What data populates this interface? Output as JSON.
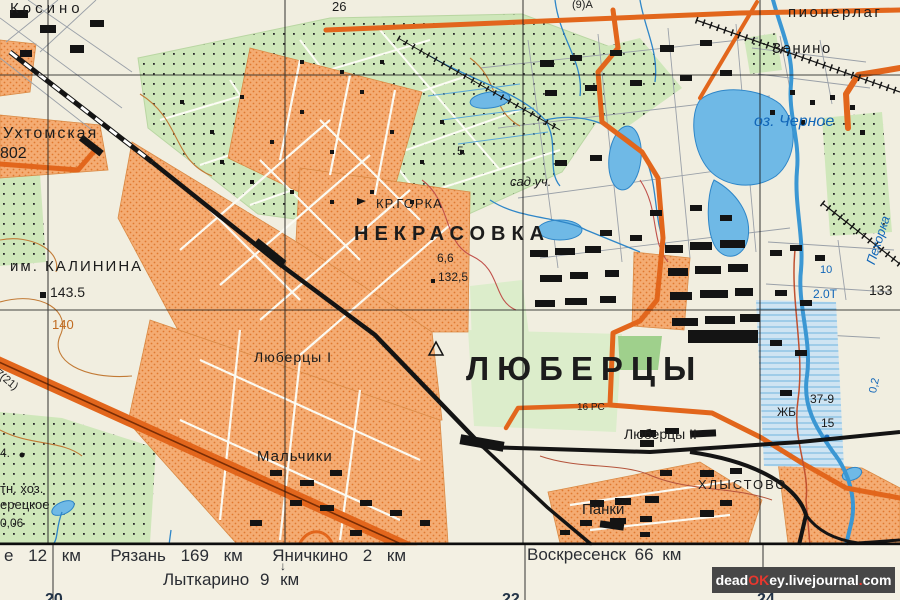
{
  "map": {
    "colors": {
      "background": "#f1eee0",
      "urban_fill": "#f4ac73",
      "urban_dot": "#e0792f",
      "road_orange": "#e2661c",
      "rail_black": "#141414",
      "water_fill": "#6fb9e6",
      "water_line": "#2e86c8",
      "veg_green": "#cfe7ba",
      "park_green": "#9fd08c",
      "contour_brown": "#c27a35",
      "label_blue": "#1166b8",
      "margin_bg": "#f3f0e3",
      "watermark_bg": "#474747",
      "watermark_red": "#e8372e"
    },
    "labels": [
      {
        "id": "kosino",
        "t": "Косино",
        "x": 10,
        "y": 1,
        "fs": 15,
        "ls": 4
      },
      {
        "id": "grid-26",
        "t": "26",
        "x": 332,
        "y": 0,
        "fs": 13
      },
      {
        "id": "road-9a",
        "t": "(9)А",
        "x": 572,
        "y": 0,
        "fs": 11
      },
      {
        "id": "pionerlag",
        "t": "пионерлаг",
        "x": 788,
        "y": 5,
        "fs": 15,
        "ls": 2.5
      },
      {
        "id": "zenino",
        "t": "Зенино",
        "x": 772,
        "y": 41,
        "fs": 15,
        "ls": 1.5
      },
      {
        "id": "oz-chernoe",
        "t": "оз. Черное",
        "x": 754,
        "y": 114,
        "fs": 16,
        "c": "blue",
        "i": 1
      },
      {
        "id": "pehorka",
        "t": "Пехорка",
        "x": 864,
        "y": 262,
        "fs": 13,
        "c": "blue",
        "i": 1,
        "rot": -72
      },
      {
        "id": "uhtomskaya",
        "t": "Ухтомская",
        "x": 3,
        "y": 126,
        "fs": 16,
        "ls": 2
      },
      {
        "id": "grid-802",
        "t": "802",
        "x": 0,
        "y": 146,
        "fs": 16
      },
      {
        "id": "pt-5",
        "t": "5",
        "x": 457,
        "y": 145,
        "fs": 12
      },
      {
        "id": "sad-uch",
        "t": "сад уч.",
        "x": 510,
        "y": 175,
        "fs": 13,
        "i": 1
      },
      {
        "id": "kr-gorka",
        "t": "КР.ГОРКА",
        "x": 376,
        "y": 197,
        "fs": 13,
        "ls": 1
      },
      {
        "id": "nekrasovka",
        "t": "НЕКРАСОВКА",
        "x": 354,
        "y": 224,
        "fs": 20,
        "ls": 6,
        "fw": 600
      },
      {
        "id": "h-66",
        "t": "6,6",
        "x": 437,
        "y": 252,
        "fs": 12
      },
      {
        "id": "h-1325",
        "t": "132,5",
        "x": 438,
        "y": 271,
        "fs": 12
      },
      {
        "id": "im-kalinina",
        "t": "им. КАЛИНИНА",
        "x": 10,
        "y": 259,
        "fs": 15,
        "ls": 2
      },
      {
        "id": "h-1435",
        "t": "143.5",
        "x": 50,
        "y": 285,
        "fs": 14
      },
      {
        "id": "b-10",
        "t": "10",
        "x": 820,
        "y": 265,
        "fs": 11,
        "c": "blue"
      },
      {
        "id": "b-20t",
        "t": "2.0Т",
        "x": 813,
        "y": 288,
        "fs": 12,
        "c": "blue"
      },
      {
        "id": "grid-133",
        "t": "133",
        "x": 869,
        "y": 283,
        "fs": 14
      },
      {
        "id": "c-140",
        "t": "140",
        "x": 52,
        "y": 318,
        "fs": 13,
        "c": "orange"
      },
      {
        "id": "road-721",
        "t": "7(21)",
        "x": 0,
        "y": 368,
        "fs": 11,
        "rot": 40
      },
      {
        "id": "lyubertsy-1",
        "t": "Люберцы I",
        "x": 254,
        "y": 350,
        "fs": 14,
        "ls": 1
      },
      {
        "id": "lyubertsy",
        "t": "ЛЮБЕРЦЫ",
        "x": 466,
        "y": 352,
        "fs": 33,
        "ls": 8,
        "fw": 700
      },
      {
        "id": "b-02",
        "t": "0,2",
        "x": 868,
        "y": 392,
        "fs": 11,
        "c": "blue",
        "rot": -78
      },
      {
        "id": "h-379",
        "t": "37-9",
        "x": 810,
        "y": 393,
        "fs": 12
      },
      {
        "id": "zhb",
        "t": "ЖБ",
        "x": 777,
        "y": 406,
        "fs": 12
      },
      {
        "id": "rc-16",
        "t": "16 РС",
        "x": 577,
        "y": 403,
        "fs": 10
      },
      {
        "id": "h-15",
        "t": "15",
        "x": 821,
        "y": 417,
        "fs": 12
      },
      {
        "id": "lyubertsy-2",
        "t": "Люберцы II",
        "x": 624,
        "y": 427,
        "fs": 14
      },
      {
        "id": "pt-4",
        "t": "4.",
        "x": 0,
        "y": 447,
        "fs": 12
      },
      {
        "id": "malchiki",
        "t": "Мальчики",
        "x": 257,
        "y": 449,
        "fs": 15,
        "ls": 1
      },
      {
        "id": "tn-hoz",
        "t": "тн. хоз.",
        "x": 0,
        "y": 482,
        "fs": 13
      },
      {
        "id": "hlystovo",
        "t": "ХЛЫСТОВО",
        "x": 698,
        "y": 478,
        "fs": 13,
        "ls": 2
      },
      {
        "id": "eretskoe",
        "t": "ерецкое",
        "x": 0,
        "y": 498,
        "fs": 13
      },
      {
        "id": "panki",
        "t": "Панки",
        "x": 582,
        "y": 502,
        "fs": 15
      },
      {
        "id": "h-006",
        "t": "0,06",
        "x": 0,
        "y": 517,
        "fs": 12
      },
      {
        "id": "margin-ryazan",
        "t": "е 12 км  Рязань 169 км  Яничкино 2 км",
        "x": 4,
        "y": 547,
        "fs": 17,
        "c": "margin",
        "ws": 10
      },
      {
        "id": "margin-arrow",
        "t": "↓",
        "x": 280,
        "y": 560,
        "fs": 12,
        "c": "margin"
      },
      {
        "id": "margin-lytkarino",
        "t": "Лыткарино 9 км",
        "x": 163,
        "y": 571,
        "fs": 17,
        "c": "margin",
        "ws": 6
      },
      {
        "id": "margin-voskresensk",
        "t": "Воскресенск 66 км",
        "x": 527,
        "y": 546,
        "fs": 17,
        "c": "margin",
        "ws": 4
      },
      {
        "id": "grid-20",
        "t": "20",
        "x": 45,
        "y": 592,
        "fs": 16,
        "c": "navy",
        "fw": 700
      },
      {
        "id": "grid-22",
        "t": "22",
        "x": 502,
        "y": 592,
        "fs": 16,
        "c": "navy",
        "fw": 700
      },
      {
        "id": "grid-24",
        "t": "24",
        "x": 757,
        "y": 592,
        "fs": 16,
        "c": "navy",
        "fw": 700
      }
    ],
    "watermark": {
      "parts": [
        {
          "t": "dead",
          "c": "#ffffff"
        },
        {
          "t": "OK",
          "c": "#e8372e"
        },
        {
          "t": "ey",
          "c": "#ffffff"
        },
        {
          "t": ".livejournal",
          "c": "#ffffff"
        },
        {
          "t": ".",
          "c": "#e8372e"
        },
        {
          "t": "com",
          "c": "#ffffff"
        }
      ]
    }
  }
}
